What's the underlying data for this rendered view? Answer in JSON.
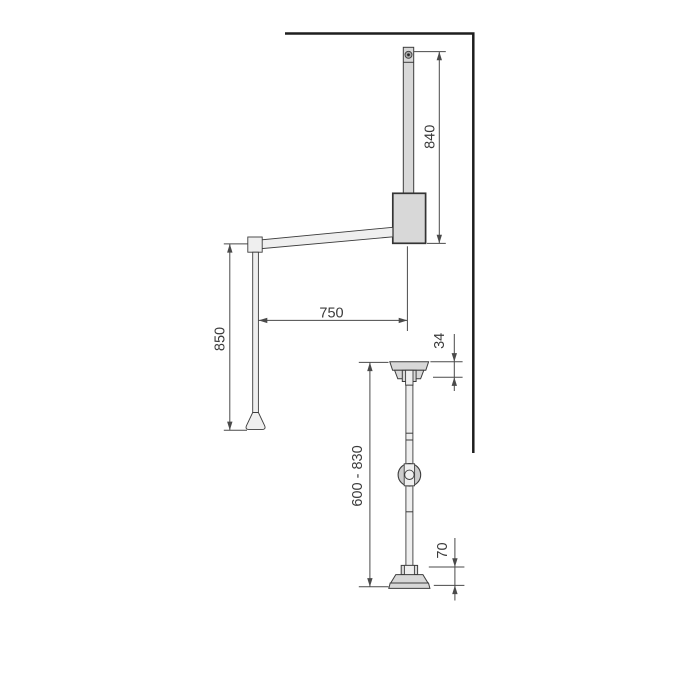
{
  "dimensions": {
    "upright_height_mm": "840",
    "arm_length_mm": "750",
    "hanging_drop_mm": "850",
    "top_bracket_mm": "34",
    "adjustable_range_mm": "600 - 830",
    "base_height_mm": "70"
  },
  "colors": {
    "background": "#ffffff",
    "wall_line": "#1e1e1e",
    "outline": "#3c3c3c",
    "outline_strong": "#343434",
    "fill_light": "#d8d8d8",
    "fill_lighter": "#efefef",
    "fill_mid": "#cccccc",
    "dimension_line": "#4a4a4a",
    "text": "#3a3a3a"
  }
}
